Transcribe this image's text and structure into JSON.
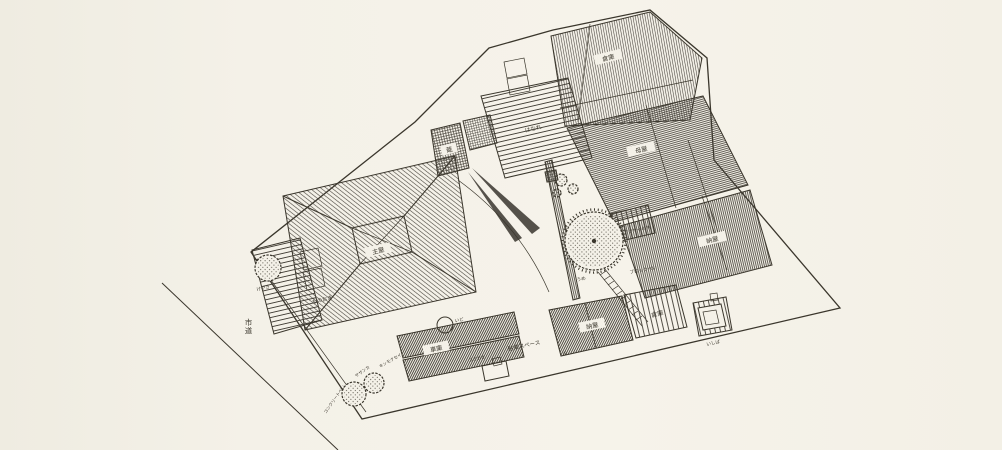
{
  "canvas": {
    "paper_color": "#f4f1e8",
    "ink_color": "#3a362c",
    "description": "Hand-drawn pen-and-ink site plan of a Japanese house compound with hatched roofs, garden trees and annotations"
  },
  "labels": {
    "souko_top": "倉庫",
    "omoya": "母屋",
    "naya_right": "納屋",
    "hanare": "はなれ",
    "kura": "蔵",
    "shuoku": "主屋",
    "monooki": "ものおき",
    "keyaki": "けやき",
    "shido": "市道",
    "parking": "駐車スペース",
    "garage": "車庫",
    "gomioki": "ゴミおき",
    "naya_bottom": "納屋",
    "souko_bottom": "倉庫",
    "ishiba": "いしば",
    "ido": "いど",
    "ume": "うめ",
    "ajisai": "アジサイの木",
    "block_wall": "ブロックべい",
    "sazanka": "サザンカ",
    "kinmokusei": "キンモクセイ",
    "concrete_wall": "コンクリートべい",
    "mark1": "①"
  }
}
